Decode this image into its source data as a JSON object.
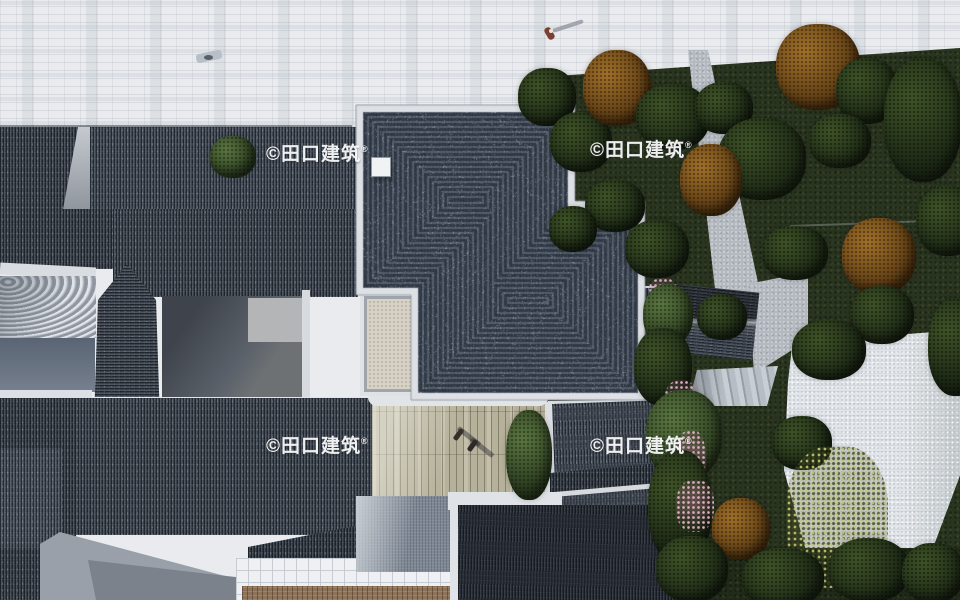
{
  "watermark": {
    "label": "©田口建筑",
    "registered": "®"
  },
  "palette": {
    "roof_dark": "#343c48",
    "roof_course_line": "#56606e",
    "roof_blue_gray": "#3a414b",
    "parapet_white": "#dde1e5",
    "paving_light": "#e9ebee",
    "lawn_green": "#2a3520",
    "plaza_white": "#e1e5e9",
    "autumn_brown": "#9a6b28",
    "courtyard_beige": "#b6b19a",
    "tile_ground_blue": "#7e8894",
    "white_grid_tile": "#eef0f3",
    "tan_walk": "#8d7258"
  }
}
